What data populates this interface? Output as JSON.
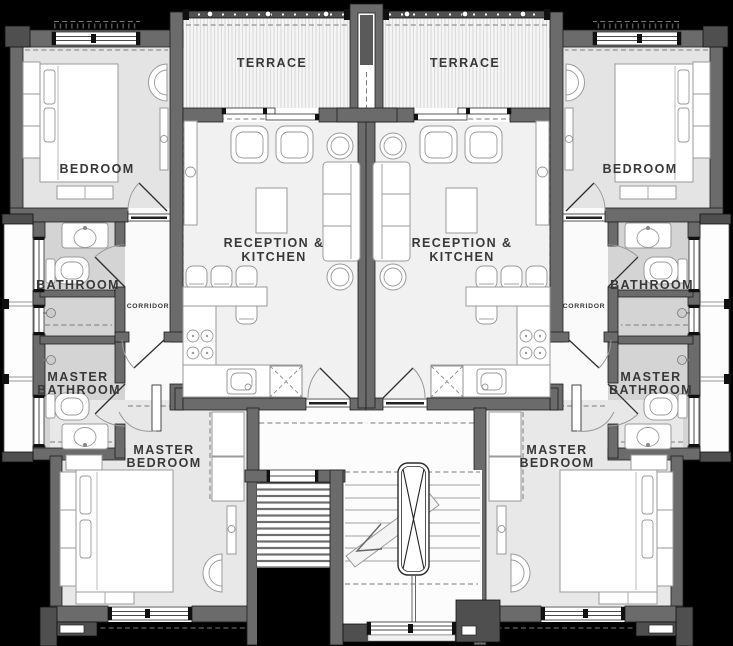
{
  "colors": {
    "bg": "#000000",
    "wall": "#6b6b6b",
    "wallDark": "#4f4f4f",
    "floorLight": "#f1f1f1",
    "floorBedroom": "#e4e4e4",
    "floorBath": "#d4d4d4",
    "label": "#383838"
  },
  "units": {
    "left": {
      "terrace": "TERRACE",
      "bedroom": "BEDROOM",
      "reception_line1": "RECEPTION &",
      "reception_line2": "KITCHEN",
      "bathroom": "BATHROOM",
      "corridor": "CORRIDOR",
      "master_bathroom_line1": "MASTER",
      "master_bathroom_line2": "BATHROOM",
      "master_bedroom_line1": "MASTER",
      "master_bedroom_line2": "BEDROOM"
    },
    "right": {
      "terrace": "TERRACE",
      "bedroom": "BEDROOM",
      "reception_line1": "RECEPTION &",
      "reception_line2": "KITCHEN",
      "bathroom": "BATHROOM",
      "corridor": "CORRIDOR",
      "master_bathroom_line1": "MASTER",
      "master_bathroom_line2": "BATHROOM",
      "master_bedroom_line1": "MASTER",
      "master_bedroom_line2": "BEDROOM"
    }
  }
}
